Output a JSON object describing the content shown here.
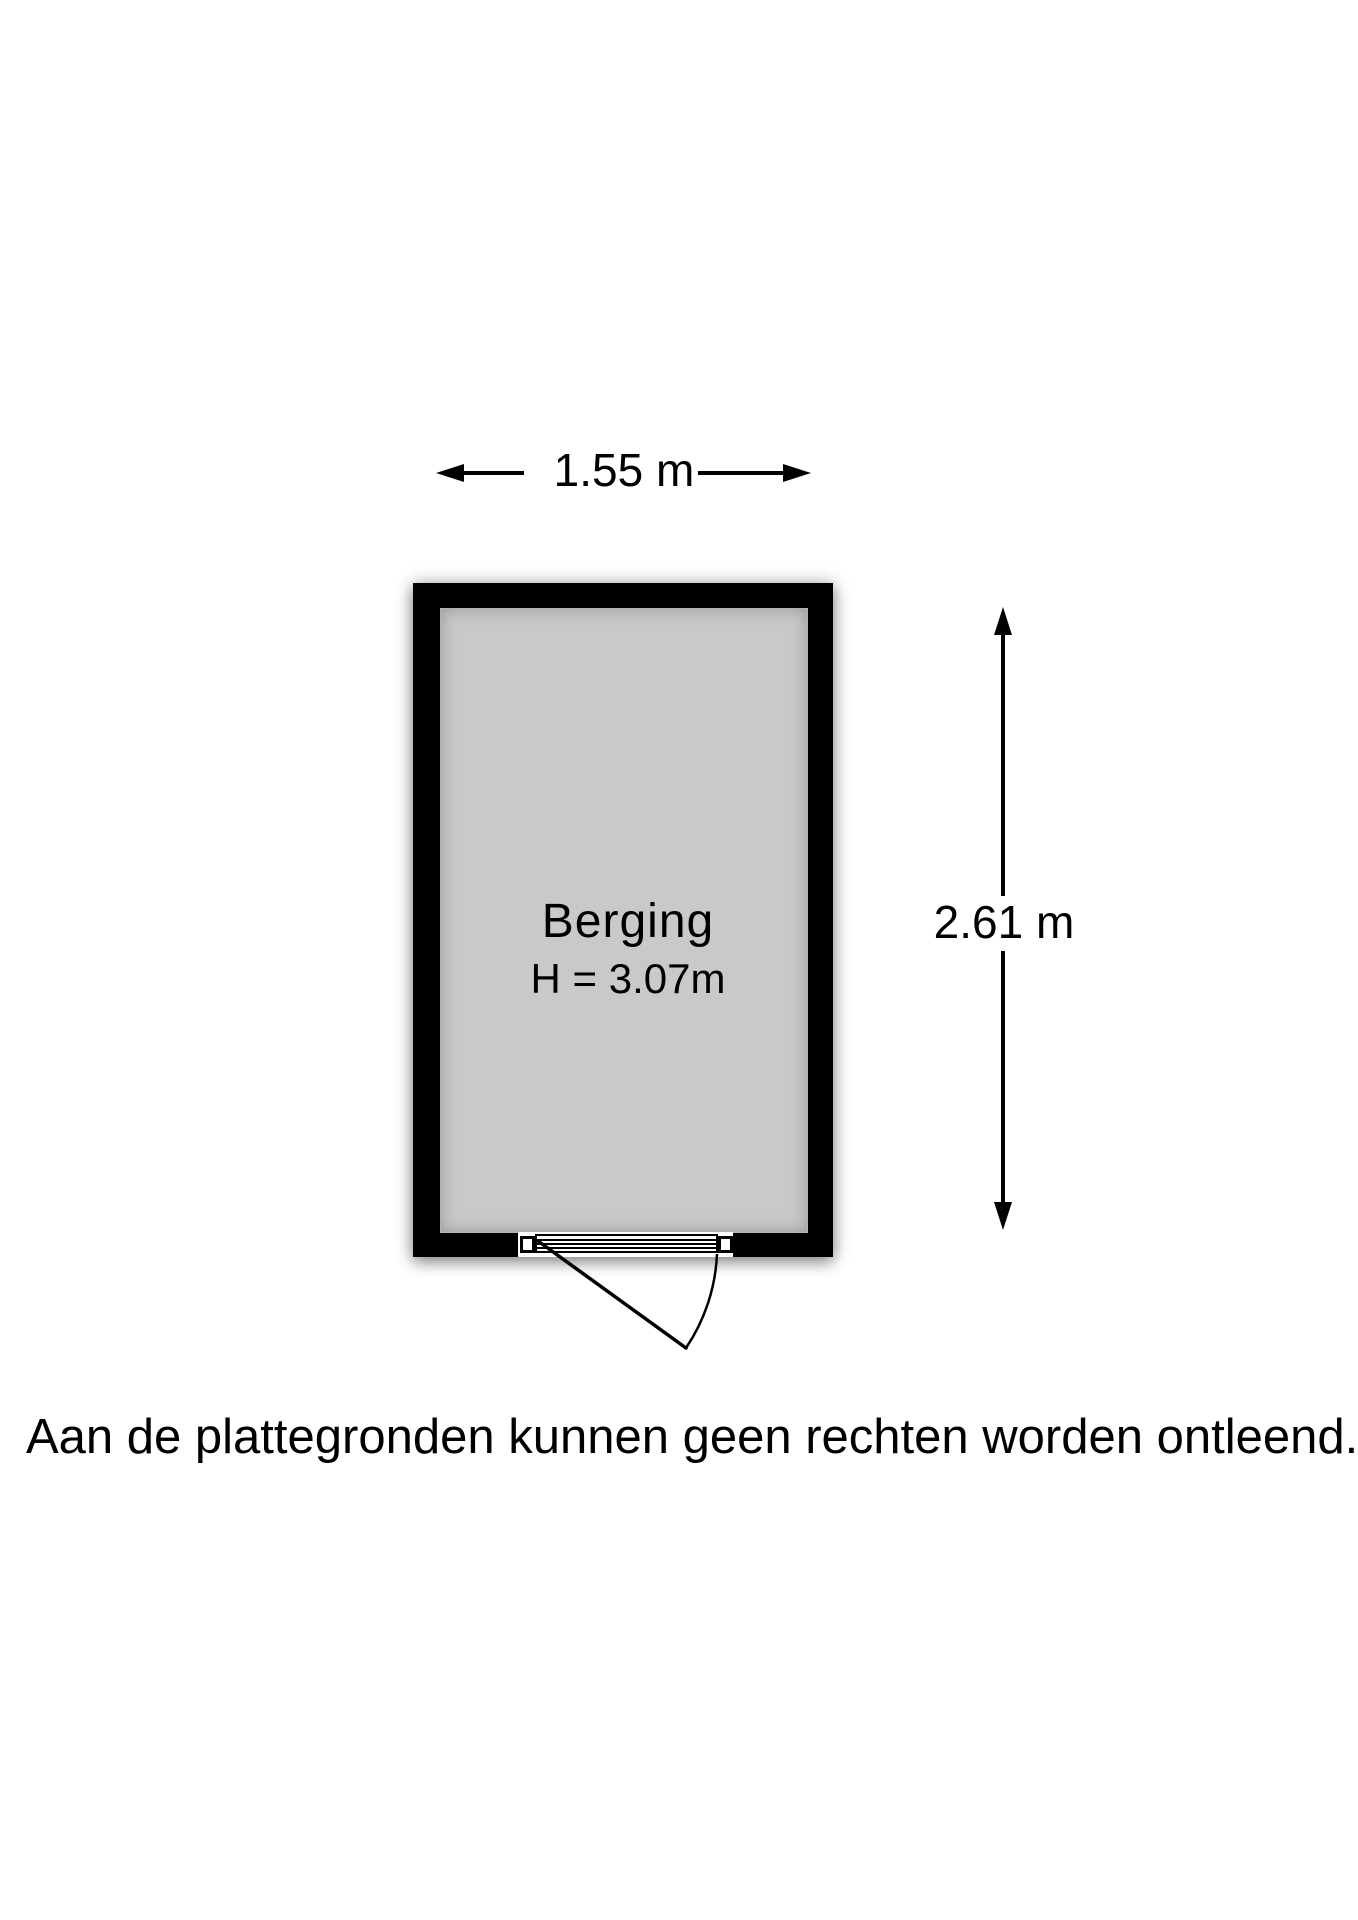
{
  "floor_plan": {
    "width_dimension": {
      "label": "1.55 m"
    },
    "height_dimension": {
      "label": "2.61 m"
    },
    "room": {
      "name": "Berging",
      "ceiling_height": "H = 3.07m"
    },
    "colors": {
      "wall": "#000000",
      "floor": "#c9c9c9",
      "background": "#ffffff",
      "text": "#000000"
    }
  },
  "disclaimer": "Aan de plattegronden kunnen geen rechten worden ontleend."
}
